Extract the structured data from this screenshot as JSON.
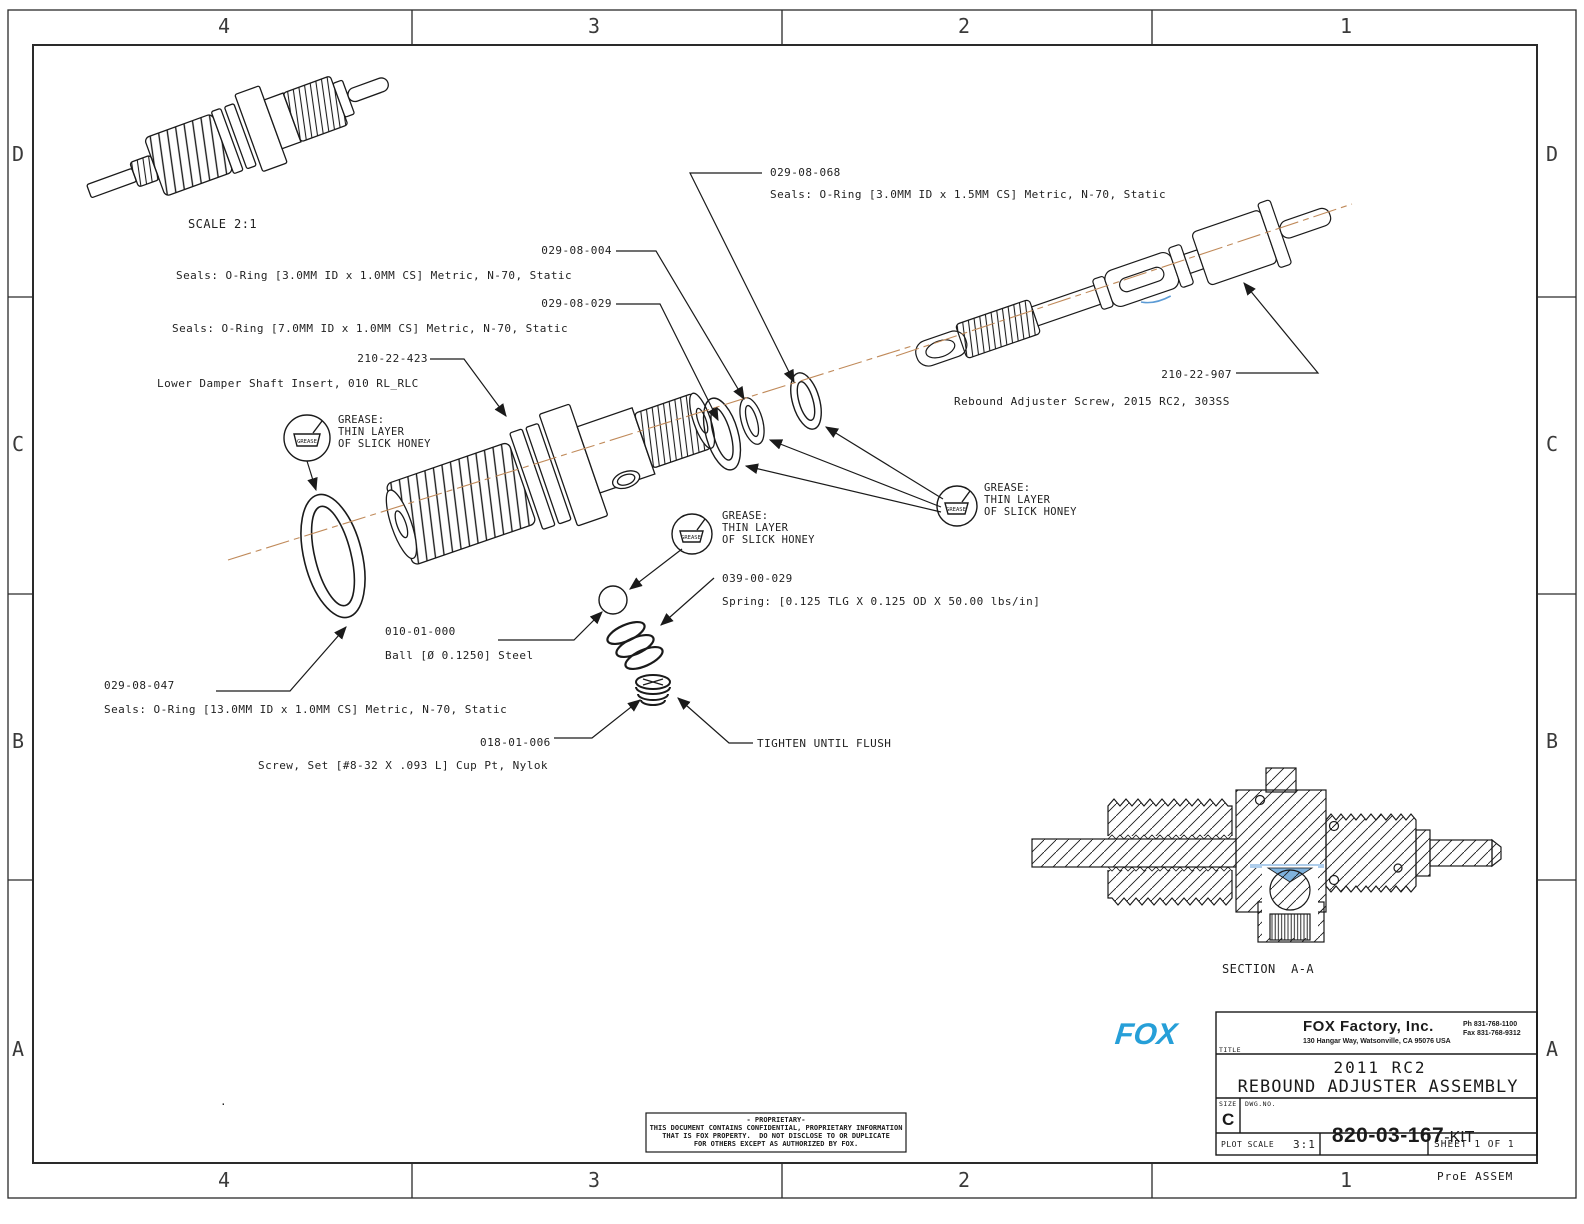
{
  "zones": {
    "cols": [
      "4",
      "3",
      "2",
      "1"
    ],
    "rows": [
      "D",
      "C",
      "B",
      "A"
    ]
  },
  "labels": {
    "assembled_scale": "SCALE 2:1",
    "section": "SECTION  A-A",
    "tighten": "TIGHTEN UNTIL FLUSH",
    "plot_env": "ProE ASSEM",
    "stray_dot": "."
  },
  "callouts": {
    "c068": {
      "pn": "029-08-068",
      "desc": "Seals: O-Ring [3.0MM ID x 1.5MM CS] Metric, N-70, Static"
    },
    "c004": {
      "pn": "029-08-004",
      "desc": "Seals: O-Ring [3.0MM ID x 1.0MM CS] Metric, N-70, Static"
    },
    "c029": {
      "pn": "029-08-029",
      "desc": "Seals: O-Ring [7.0MM ID x 1.0MM CS] Metric, N-70, Static"
    },
    "c423": {
      "pn": "210-22-423",
      "desc": "Lower Damper Shaft Insert, 010 RL_RLC"
    },
    "c907": {
      "pn": "210-22-907",
      "desc": "Rebound Adjuster Screw, 2015 RC2, 303SS"
    },
    "c039": {
      "pn": "039-00-029",
      "desc": "Spring: [0.125 TLG X 0.125 OD X 50.00 lbs/in]"
    },
    "c010": {
      "pn": "010-01-000",
      "desc": "Ball [Ø 0.1250] Steel"
    },
    "c047": {
      "pn": "029-08-047",
      "desc": "Seals: O-Ring [13.0MM ID x 1.0MM CS] Metric, N-70, Static"
    },
    "c018": {
      "pn": "018-01-006",
      "desc": "Screw, Set [#8-32 X .093 L] Cup Pt, Nylok"
    }
  },
  "grease_note": {
    "l1": "GREASE:",
    "l2": "THIN LAYER",
    "l3": "OF SLICK HONEY",
    "symbol": "GREASE"
  },
  "title_block": {
    "logo": "FOX",
    "company": "FOX Factory, Inc.",
    "address": "130 Hangar Way, Watsonville, CA 95076 USA",
    "phone": "Ph 831-768-1100",
    "fax": "Fax 831-768-9312",
    "title_label": "TITLE",
    "title_line1": "2011 RC2",
    "title_line2": "REBOUND ADJUSTER ASSEMBLY",
    "size_label": "SIZE",
    "size": "C",
    "dwg_label": "DWG.NO.",
    "dwg_no": "820-03-167",
    "dwg_suffix": "-KIT",
    "plot_scale_label": "PLOT SCALE",
    "plot_scale": "3:1",
    "sheet": "SHEET 1 OF 1"
  },
  "proprietary": {
    "l1": "- PROPRIETARY-",
    "l2": "THIS DOCUMENT CONTAINS CONFIDENTIAL, PROPRIETARY INFORMATION",
    "l3": "THAT IS FOX PROPERTY.  DO NOT DISCLOSE TO OR DUPLICATE",
    "l4": "FOR OTHERS EXCEPT AS AUTHORIZED BY FOX."
  },
  "colors": {
    "line": "#1a1a1a",
    "centerline": "#c08a5a",
    "accent_blue": "#5b9bd5",
    "logo_blue": "#269fd8"
  }
}
